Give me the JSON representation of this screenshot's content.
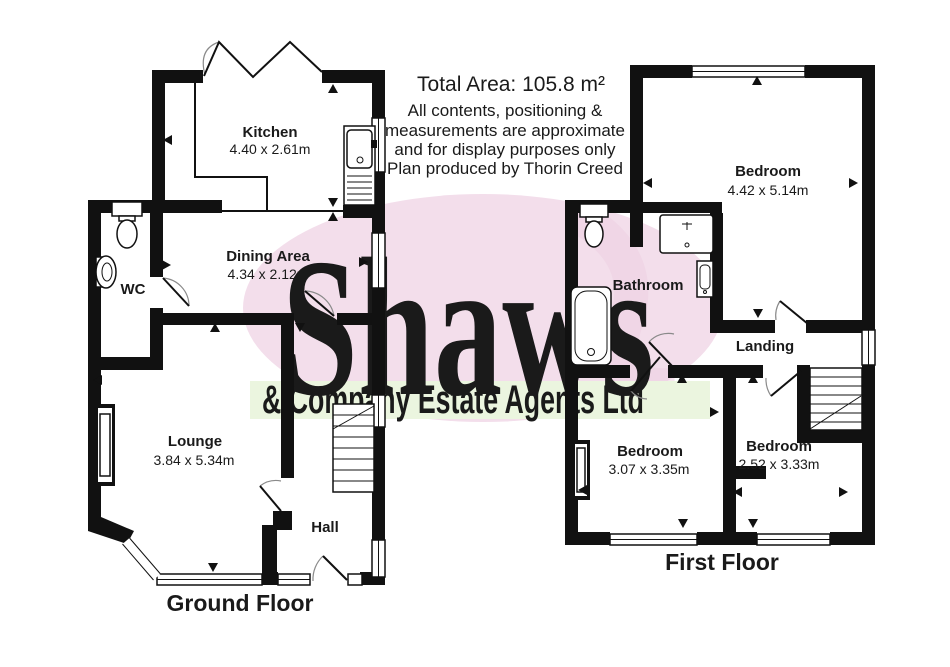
{
  "header": {
    "total_area": "Total Area: 105.8 m²",
    "disclaimer_line1": "All contents, positioning &",
    "disclaimer_line2": "measurements are approximate",
    "disclaimer_line3": "and for display purposes only",
    "disclaimer_line4": "Plan produced by Thorin Creed"
  },
  "watermark": {
    "name": "Shaws",
    "subtitle": "& Company Estate Agents Ltd"
  },
  "ground_floor": {
    "label": "Ground Floor",
    "kitchen_name": "Kitchen",
    "kitchen_dims": "4.40 x 2.61m",
    "dining_name": "Dining Area",
    "dining_dims": "4.34 x 2.12m",
    "wc_name": "WC",
    "lounge_name": "Lounge",
    "lounge_dims": "3.84 x 5.34m",
    "hall_name": "Hall"
  },
  "first_floor": {
    "label": "First Floor",
    "bedroom1_name": "Bedroom",
    "bedroom1_dims": "4.42 x 5.14m",
    "bathroom_name": "Bathroom",
    "landing_name": "Landing",
    "bedroom2_name": "Bedroom",
    "bedroom2_dims": "3.07 x 3.35m",
    "bedroom3_name": "Bedroom",
    "bedroom3_dims": "2.52 x 3.33m"
  },
  "colors": {
    "wall": "#111111",
    "watermark_pink": "#f3deeb",
    "watermark_letters": "#fbf1f8",
    "watermark_green_band": "#ebf5df",
    "watermark_green_text": "#cfe7ae"
  }
}
